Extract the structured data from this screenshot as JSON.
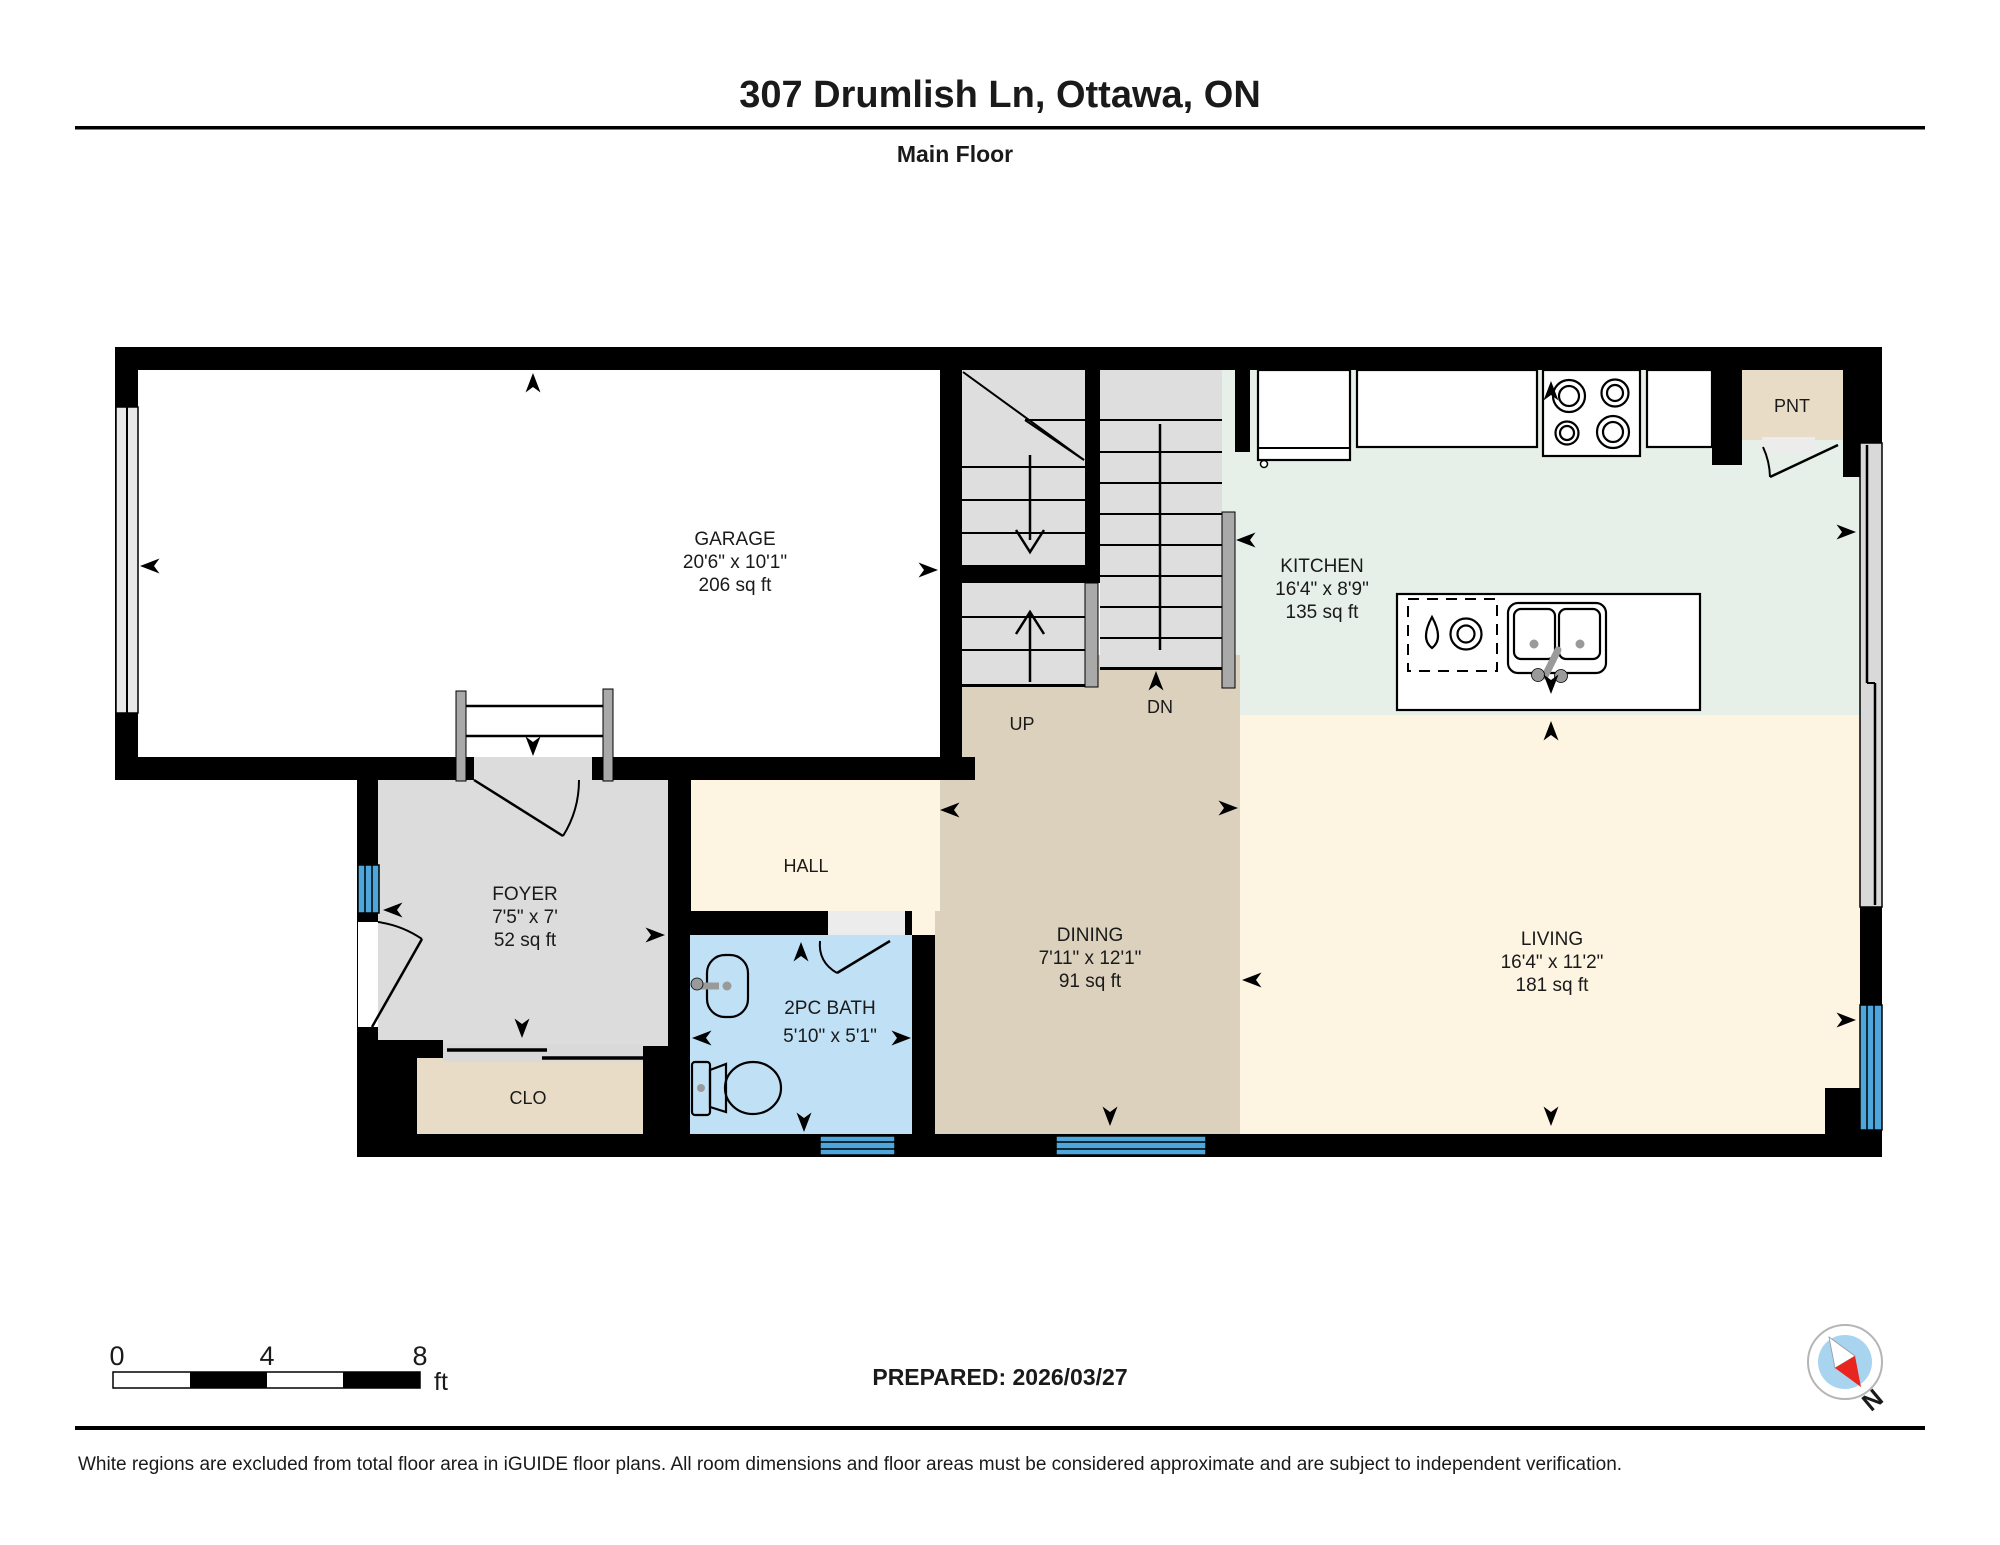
{
  "header": {
    "title": "307 Drumlish Ln, Ottawa, ON",
    "floor": "Main Floor"
  },
  "rooms": {
    "garage": {
      "name": "GARAGE",
      "dims": "20'6\" x 10'1\"",
      "area": "206 sq ft"
    },
    "kitchen": {
      "name": "KITCHEN",
      "dims": "16'4\" x 8'9\"",
      "area": "135 sq ft"
    },
    "dining": {
      "name": "DINING",
      "dims": "7'11\" x 12'1\"",
      "area": "91 sq ft"
    },
    "living": {
      "name": "LIVING",
      "dims": "16'4\" x 11'2\"",
      "area": "181 sq ft"
    },
    "foyer": {
      "name": "FOYER",
      "dims": "7'5\" x 7'",
      "area": "52 sq ft"
    },
    "bath": {
      "name": "2PC BATH",
      "dims": "5'10\" x 5'1\""
    },
    "hall": {
      "name": "HALL"
    },
    "closet": {
      "name": "CLO"
    },
    "pantry": {
      "name": "PNT"
    },
    "stairs": {
      "up": "UP",
      "down": "DN"
    }
  },
  "scale_bar": {
    "labels": [
      "0",
      "4",
      "8"
    ],
    "unit": "ft"
  },
  "footer": {
    "prepared": "PREPARED: 2026/03/27",
    "disclaimer": "White regions are excluded from total floor area in iGUIDE floor plans. All room dimensions and floor areas must be considered approximate and are subject to independent verification."
  },
  "compass": {
    "north_label": "N"
  },
  "colors": {
    "wall": "#000000",
    "garage_floor": "#ffffff",
    "stairs_floor": "#dedede",
    "kitchen_floor": "#e6efe8",
    "living_floor": "#fdf5e1",
    "dining_floor": "#dcd1bd",
    "foyer_floor": "#dcdcdc",
    "closet_floor": "#e9dcc6",
    "bath_floor": "#bfe0f5",
    "window": "#4da7dc",
    "railing": "#a9a9a9",
    "slider_door": "#d9d9d9",
    "compass_blue": "#a8d4f0",
    "compass_red": "#e8251f"
  }
}
